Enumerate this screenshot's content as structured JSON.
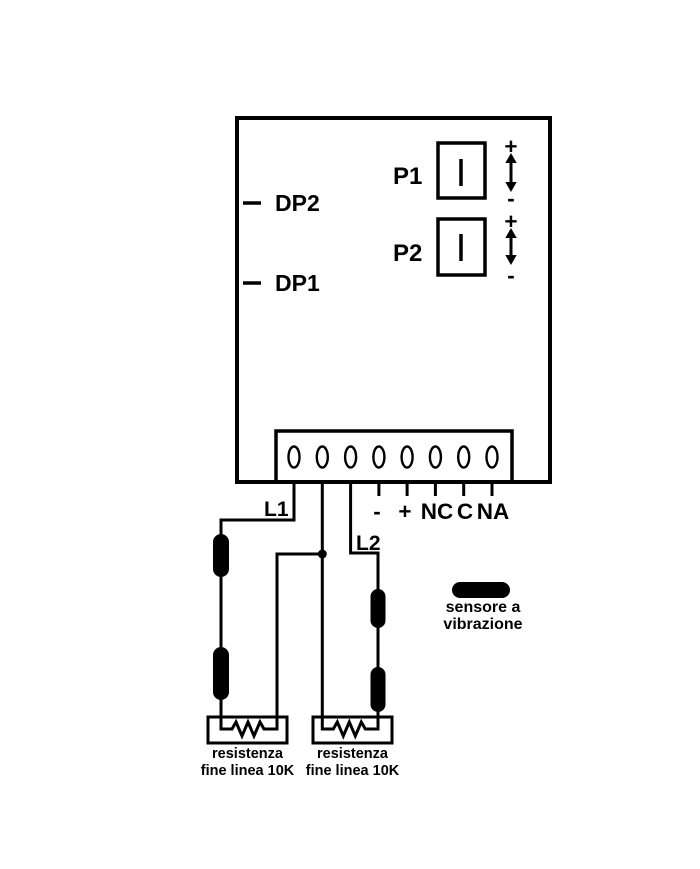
{
  "colors": {
    "ink": "#000000",
    "background": "#ffffff"
  },
  "board": {
    "dip_points": [
      {
        "label": "DP2"
      },
      {
        "label": "DP1"
      }
    ],
    "trimmers": [
      {
        "name": "P1",
        "plus": "+",
        "minus": "-"
      },
      {
        "name": "P2",
        "plus": "+",
        "minus": "-"
      }
    ]
  },
  "terminal_block": {
    "terminal_count": 8,
    "labels": {
      "minus": "-",
      "plus": "+",
      "nc": "NC",
      "c": "C",
      "na": "NA"
    }
  },
  "zones": [
    {
      "label": "L1"
    },
    {
      "label": "L2"
    }
  ],
  "legend": {
    "sensor_line1": "sensore a",
    "sensor_line2": "vibrazione"
  },
  "eol_resistors": [
    {
      "caption_line1": "resistenza",
      "caption_line2": "fine linea 10K"
    },
    {
      "caption_line1": "resistenza",
      "caption_line2": "fine linea 10K"
    }
  ]
}
